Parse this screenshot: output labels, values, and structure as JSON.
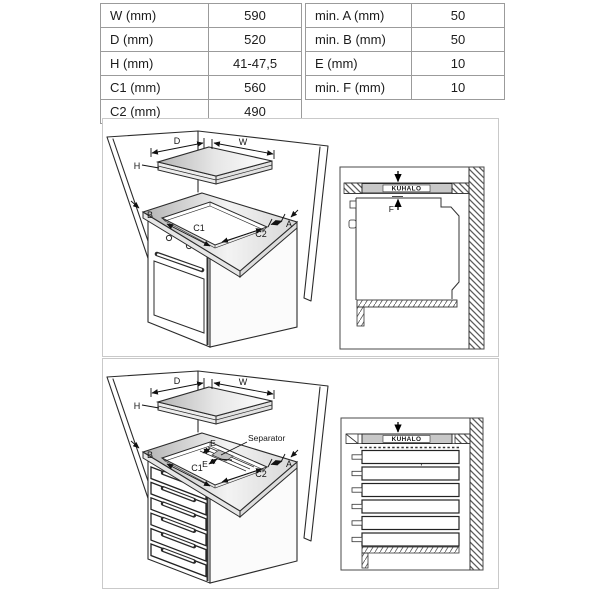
{
  "table": {
    "left_rows": [
      {
        "label": "W (mm)",
        "value": "590"
      },
      {
        "label": "D (mm)",
        "value": "520"
      },
      {
        "label": "H (mm)",
        "value": "41-47,5"
      },
      {
        "label": "C1 (mm)",
        "value": "560"
      },
      {
        "label": "C2 (mm)",
        "value": "490"
      }
    ],
    "right_rows": [
      {
        "label": "min. A (mm)",
        "value": "50"
      },
      {
        "label": "min. B (mm)",
        "value": "50"
      },
      {
        "label": "E (mm)",
        "value": "10"
      },
      {
        "label": "min. F (mm)",
        "value": "10"
      }
    ]
  },
  "diagram_top": {
    "labels": {
      "d": "D",
      "w": "W",
      "h": "H",
      "b": "B",
      "a": "A",
      "c1": "C1",
      "c2": "C2"
    },
    "detail": {
      "kuhalo": "KUHALO",
      "f": "F"
    }
  },
  "diagram_bottom": {
    "labels": {
      "d": "D",
      "w": "W",
      "h": "H",
      "b": "B",
      "a": "A",
      "c1": "C1",
      "c2": "C2",
      "e1": "E",
      "e2": "E",
      "separator_callout": "Separator"
    },
    "detail": {
      "kuhalo": "KUHALO",
      "f": "F",
      "separator": "Separator"
    }
  },
  "colors": {
    "line": "#2b2b2b",
    "band_gray": "#c8c8c8",
    "panel_border": "#c9c9c9",
    "table_border": "#9b9b9b"
  }
}
